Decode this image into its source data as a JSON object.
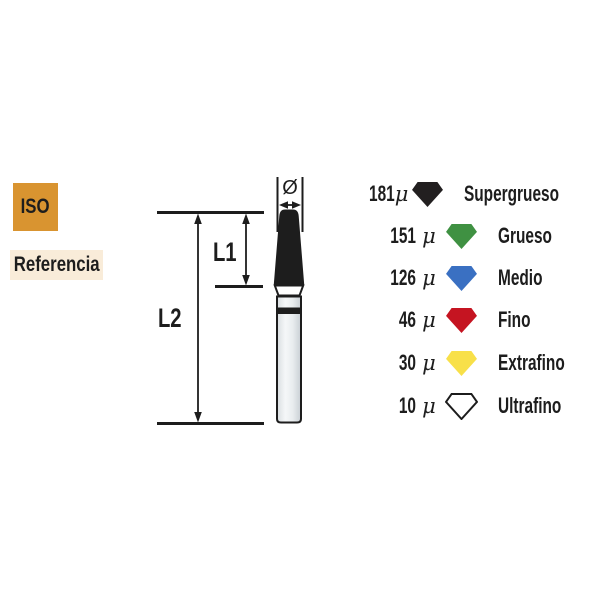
{
  "badges": {
    "iso_label": "ISO",
    "referencia_label": "Referencia"
  },
  "diagram": {
    "l1_label": "L1",
    "l2_label": "L2",
    "diameter_symbol": "Ø"
  },
  "legend": {
    "rows": [
      {
        "value": "181",
        "unit": "μ",
        "label": "Supergrueso",
        "color": "#221f20",
        "outlined": false
      },
      {
        "value": "151",
        "unit": "μ",
        "label": "Grueso",
        "color": "#3f9142",
        "outlined": false
      },
      {
        "value": "126",
        "unit": "μ",
        "label": "Medio",
        "color": "#3a70c2",
        "outlined": false
      },
      {
        "value": "46",
        "unit": "μ",
        "label": "Fino",
        "color": "#c51421",
        "outlined": false
      },
      {
        "value": "30",
        "unit": "μ",
        "label": "Extrafino",
        "color": "#f8e049",
        "outlined": false
      },
      {
        "value": "10",
        "unit": "μ",
        "label": "Ultrafino",
        "color": "#ffffff",
        "outlined": true
      }
    ]
  },
  "colors": {
    "iso_badge_bg": "#d99430",
    "referencia_badge_bg": "#f9ecd9",
    "ink": "#1d1d1d",
    "bur_head": "#1d1d1d",
    "shank_gray": "#dfe3e6"
  }
}
